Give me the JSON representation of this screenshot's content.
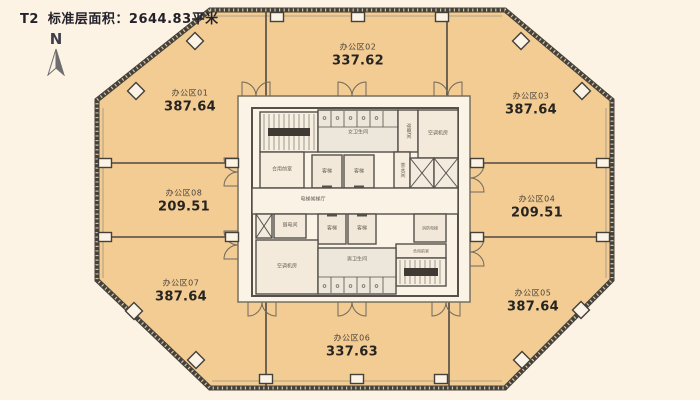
{
  "title": {
    "tower": "T2",
    "label": "标准层面积：2644.83平米"
  },
  "compass": {
    "label": "N"
  },
  "zones": [
    {
      "id": "01",
      "name": "办公区01",
      "area": "387.64",
      "cx": 190,
      "cy": 101
    },
    {
      "id": "02",
      "name": "办公区02",
      "area": "337.62",
      "cx": 358,
      "cy": 55
    },
    {
      "id": "03",
      "name": "办公区03",
      "area": "387.64",
      "cx": 531,
      "cy": 104
    },
    {
      "id": "04",
      "name": "办公区04",
      "area": "209.51",
      "cx": 537,
      "cy": 207
    },
    {
      "id": "05",
      "name": "办公区05",
      "area": "387.64",
      "cx": 533,
      "cy": 301
    },
    {
      "id": "06",
      "name": "办公区06",
      "area": "337.63",
      "cx": 352,
      "cy": 346
    },
    {
      "id": "07",
      "name": "办公区07",
      "area": "387.64",
      "cx": 181,
      "cy": 291
    },
    {
      "id": "08",
      "name": "办公区08",
      "area": "209.51",
      "cx": 184,
      "cy": 201
    }
  ],
  "core": {
    "rooms": [
      {
        "label": "",
        "x": 260,
        "y": 112,
        "w": 58,
        "h": 40,
        "kind": "stair",
        "type": "stair"
      },
      {
        "label": "合用前室",
        "x": 260,
        "y": 152,
        "w": 44,
        "h": 36,
        "kind": "default"
      },
      {
        "label": "女卫生间",
        "x": 318,
        "y": 110,
        "w": 80,
        "h": 42,
        "kind": "toilet",
        "type": "wtoilet",
        "ly": 133
      },
      {
        "label": "强电间",
        "x": 398,
        "y": 110,
        "w": 20,
        "h": 42,
        "kind": "service",
        "vertical": true
      },
      {
        "label": "空调机房",
        "x": 418,
        "y": 110,
        "w": 40,
        "h": 48,
        "kind": "service"
      },
      {
        "label": "客梯",
        "x": 312,
        "y": 155,
        "w": 30,
        "h": 33,
        "kind": "lift",
        "type": "lift-down"
      },
      {
        "label": "客梯",
        "x": 344,
        "y": 155,
        "w": 30,
        "h": 33,
        "kind": "lift",
        "type": "lift-down"
      },
      {
        "label": "茶水间",
        "x": 394,
        "y": 152,
        "w": 16,
        "h": 36,
        "kind": "default",
        "vertical": true
      },
      {
        "label": "",
        "x": 410,
        "y": 158,
        "w": 24,
        "h": 30,
        "kind": "shaft",
        "type": "brace"
      },
      {
        "label": "",
        "x": 434,
        "y": 158,
        "w": 24,
        "h": 30,
        "kind": "shaft",
        "type": "brace"
      },
      {
        "label": "电梯候梯厅",
        "x": 252,
        "y": 188,
        "w": 206,
        "h": 26,
        "kind": "lobby",
        "lx": 313,
        "ly": 200
      },
      {
        "label": "",
        "x": 256,
        "y": 214,
        "w": 16,
        "h": 24,
        "kind": "shaft",
        "type": "brace"
      },
      {
        "label": "弱电间",
        "x": 274,
        "y": 214,
        "w": 32,
        "h": 24,
        "kind": "service"
      },
      {
        "label": "客梯",
        "x": 318,
        "y": 214,
        "w": 28,
        "h": 30,
        "kind": "lift",
        "type": "lift-up"
      },
      {
        "label": "客梯",
        "x": 348,
        "y": 214,
        "w": 28,
        "h": 30,
        "kind": "lift",
        "type": "lift-up"
      },
      {
        "label": "消防电梯",
        "x": 414,
        "y": 214,
        "w": 32,
        "h": 28,
        "kind": "lift",
        "fs": 4
      },
      {
        "label": "合用前室",
        "x": 396,
        "y": 244,
        "w": 50,
        "h": 14,
        "kind": "default",
        "fs": 4
      },
      {
        "label": "",
        "x": 396,
        "y": 258,
        "w": 50,
        "h": 28,
        "kind": "stair",
        "type": "stairB"
      },
      {
        "label": "空调机房",
        "x": 256,
        "y": 240,
        "w": 62,
        "h": 54,
        "kind": "service"
      },
      {
        "label": "男卫生间",
        "x": 318,
        "y": 248,
        "w": 78,
        "h": 46,
        "kind": "toilet",
        "type": "mtoilet",
        "ly": 260
      }
    ]
  },
  "doors": [
    {
      "x": 256,
      "y": 96,
      "dir": "up"
    },
    {
      "x": 352,
      "y": 96,
      "dir": "up"
    },
    {
      "x": 448,
      "y": 96,
      "dir": "up"
    },
    {
      "x": 262,
      "y": 302,
      "dir": "down"
    },
    {
      "x": 352,
      "y": 302,
      "dir": "down"
    },
    {
      "x": 446,
      "y": 302,
      "dir": "down"
    },
    {
      "x": 238,
      "y": 172,
      "dir": "left"
    },
    {
      "x": 238,
      "y": 245,
      "dir": "left"
    },
    {
      "x": 470,
      "y": 178,
      "dir": "right"
    },
    {
      "x": 470,
      "y": 252,
      "dir": "right"
    }
  ],
  "columns": {
    "squares": [
      [
        277,
        17
      ],
      [
        358,
        17
      ],
      [
        442,
        17
      ],
      [
        105,
        163
      ],
      [
        232,
        163
      ],
      [
        105,
        237
      ],
      [
        232,
        237
      ],
      [
        477,
        163
      ],
      [
        603,
        163
      ],
      [
        477,
        237
      ],
      [
        603,
        237
      ],
      [
        266,
        379
      ],
      [
        357,
        379
      ],
      [
        441,
        379
      ]
    ],
    "diamonds": [
      [
        136,
        91
      ],
      [
        195,
        41
      ],
      [
        521,
        41
      ],
      [
        582,
        91
      ],
      [
        134,
        311
      ],
      [
        196,
        360
      ],
      [
        522,
        360
      ],
      [
        581,
        310
      ]
    ]
  },
  "colors": {
    "bg": "#FDF3E5",
    "zoneFill": "#F3CC93",
    "wall": "#46423A",
    "innerLine": "#4E4A42",
    "coreBg": "#FBF3E6",
    "roomStroke": "#55504A",
    "fills": {
      "default": "#F7EDDE",
      "toilet": "#EDE7DB",
      "lift": "#F1E8D9",
      "stair": "#F6EEE1",
      "lobby": "#FAF2E5",
      "shaft": "#F3EBDE",
      "service": "#F4EADC"
    }
  }
}
